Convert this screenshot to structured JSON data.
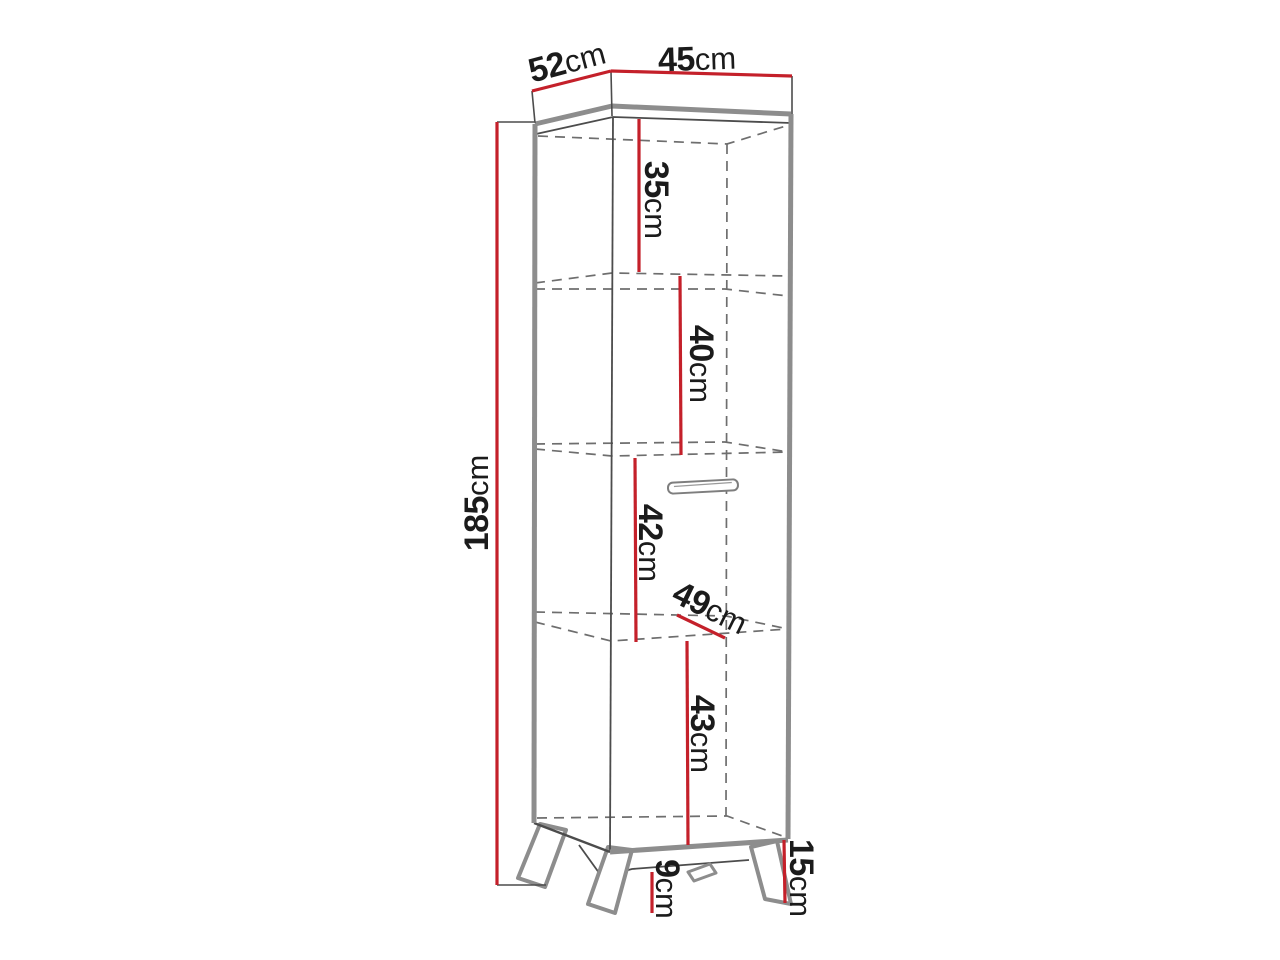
{
  "diagram": {
    "type": "furniture dimension drawing",
    "subject": "tall narrow cabinet on four splayed legs, perspective line drawing with dashed hidden edges and red dimension lines",
    "background": "#ffffff",
    "colors": {
      "dimension_line": "#c4202a",
      "outline_thick": "#8d8d8d",
      "line_thin": "#4c4c4c",
      "hidden_dashed": "#6e6e6e",
      "label_text": "#1b1b1b"
    },
    "dimensions": {
      "top_side_depth": {
        "value": "52",
        "unit": "cm"
      },
      "top_front_width": {
        "value": "45",
        "unit": "cm"
      },
      "total_height": {
        "value": "185",
        "unit": "cm"
      },
      "compartment_1": {
        "value": "35",
        "unit": "cm"
      },
      "compartment_2": {
        "value": "40",
        "unit": "cm"
      },
      "compartment_3": {
        "value": "42",
        "unit": "cm"
      },
      "shelf_depth": {
        "value": "49",
        "unit": "cm"
      },
      "compartment_4": {
        "value": "43",
        "unit": "cm"
      },
      "underside_clearance": {
        "value": "9",
        "unit": "cm"
      },
      "leg_height": {
        "value": "15",
        "unit": "cm"
      }
    }
  }
}
